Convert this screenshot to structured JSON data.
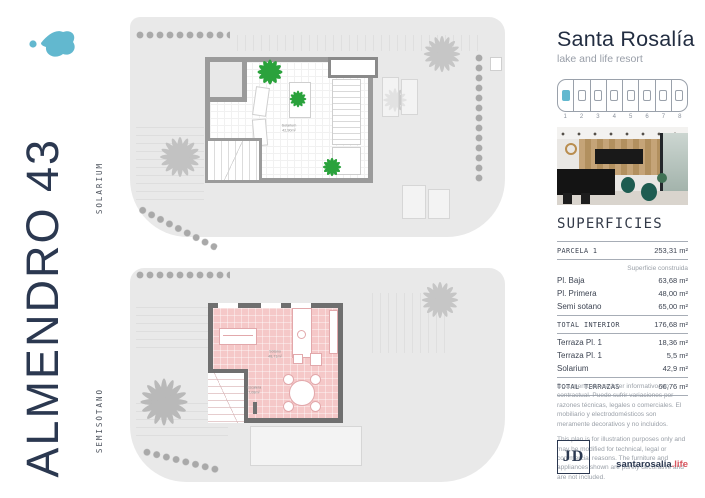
{
  "left_sidebar": {
    "project_title": "ALMENDRO 43",
    "upper_floor_label": "SOLARIUM",
    "lower_floor_label": "SEMISÓTANO"
  },
  "brand": {
    "name": "Santa Rosalía",
    "tagline": "lake and life resort",
    "accent_color": "#62b8cf",
    "navy_color": "#2b3850"
  },
  "site_map": {
    "selected_unit": "1",
    "units": [
      "1",
      "2",
      "3",
      "4",
      "5",
      "6",
      "7",
      "8"
    ]
  },
  "plans": {
    "solarium": {
      "room_label": "Solarium",
      "room_area": "42,90m²"
    },
    "semisotano": {
      "room_label": "Sótano",
      "room_area": "48,71m²",
      "stairs_label": "Escalera",
      "stairs_area": "7,08m²"
    }
  },
  "superficies": {
    "title": "SUPERFICIES",
    "parcela": {
      "label": "PARCELA 1",
      "value": "253,31 m²"
    },
    "col_header": "Superficie construida",
    "interior_rows": [
      {
        "label": "Pl. Baja",
        "value": "63,68 m²"
      },
      {
        "label": "Pl. Primera",
        "value": "48,00 m²"
      },
      {
        "label": "Semi sotano",
        "value": "65,00 m²"
      }
    ],
    "total_interior": {
      "label": "TOTAL INTERIOR",
      "value": "176,68 m²"
    },
    "terraza_rows": [
      {
        "label": "Terraza Pl. 1",
        "value": "18,36 m²"
      },
      {
        "label": "Terraza Pl. 1",
        "value": "5,5 m²"
      },
      {
        "label": "Solarium",
        "value": "42,9 m²"
      }
    ],
    "total_terrazas": {
      "label": "TOTAL TERRAZAS",
      "value": "66,76 m²"
    }
  },
  "disclaimer": {
    "es": "Documento de carácter informativo, no contractual. Puede sufrir variaciones por razones técnicas, legales o comerciales. El mobiliario y electrodomésticos son meramente decorativos y no incluidos.",
    "en": "This plan is for illustration purposes only and may be modified for technical, legal or commercial reasons. The furniture and appliances shown are purely decorative and are not included."
  },
  "footer": {
    "logo_text": "JD",
    "site_name": "santarosalia",
    "site_tld": ".life"
  }
}
